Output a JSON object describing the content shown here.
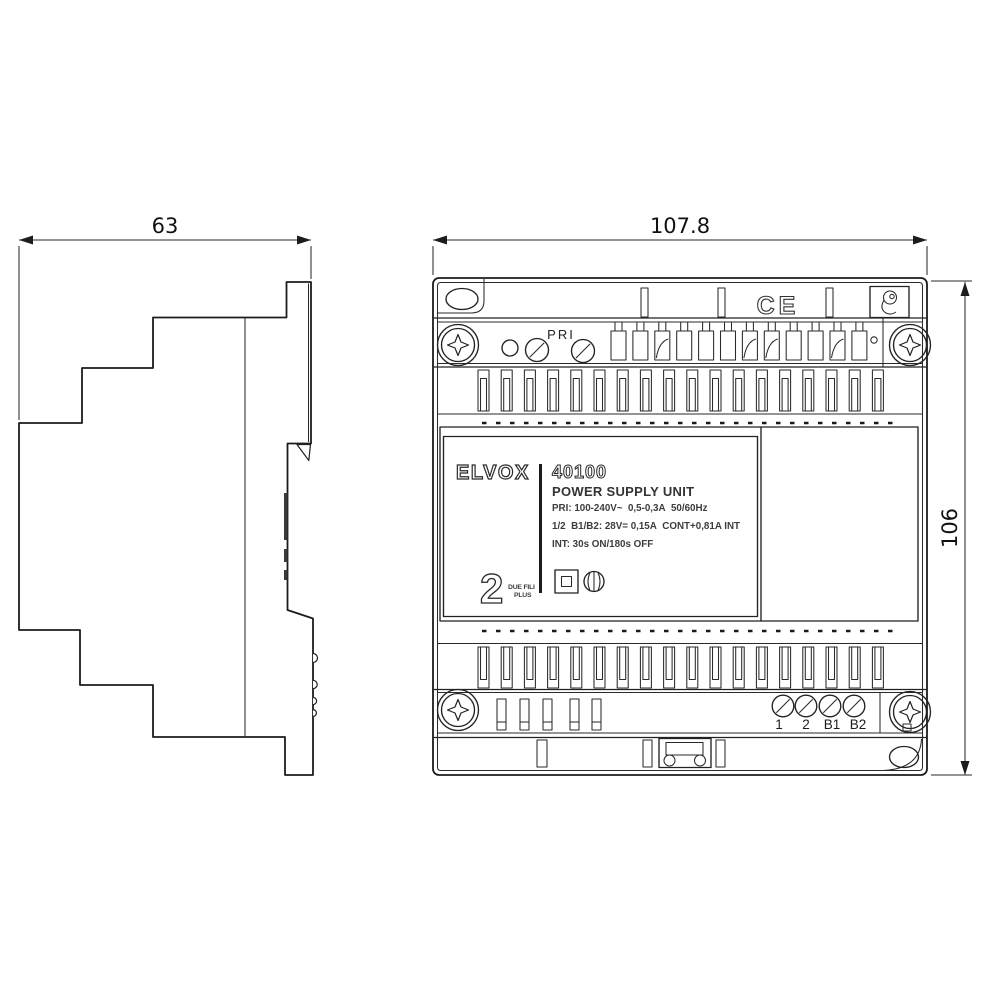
{
  "drawing": {
    "dimensions": {
      "side_width": "63",
      "front_width": "107.8",
      "front_height": "106"
    },
    "front": {
      "pri_label": "PRI",
      "ce_mark": "CE",
      "nameplate": {
        "brand": "ELVOX",
        "model": "40100",
        "product_name": "POWER SUPPLY UNIT",
        "spec_line_1": "PRI: 100-240V~  0,5-0,3A  50/60Hz",
        "spec_line_2": "1/2  B1/B2: 28V= 0,15A  CONT+0,81A INT",
        "spec_line_3": "INT: 30s ON/180s OFF",
        "system_number": "2",
        "system_name_top": "DUE FILI",
        "system_name_bottom": "PLUS"
      },
      "terminal_labels": [
        "1",
        "2",
        "B1",
        "B2"
      ]
    },
    "icons": {
      "phillips_screw": "phillips-cross",
      "slotted_screw": "circle-diagonal-slot",
      "class_ii_insulation": "square-in-square",
      "certification_mark": "circle-emblem",
      "top_right_logo": "circle-hook-emblem",
      "din_release_clip": "latch-with-holes"
    },
    "colors": {
      "line": "#222222",
      "background": "#ffffff"
    }
  }
}
